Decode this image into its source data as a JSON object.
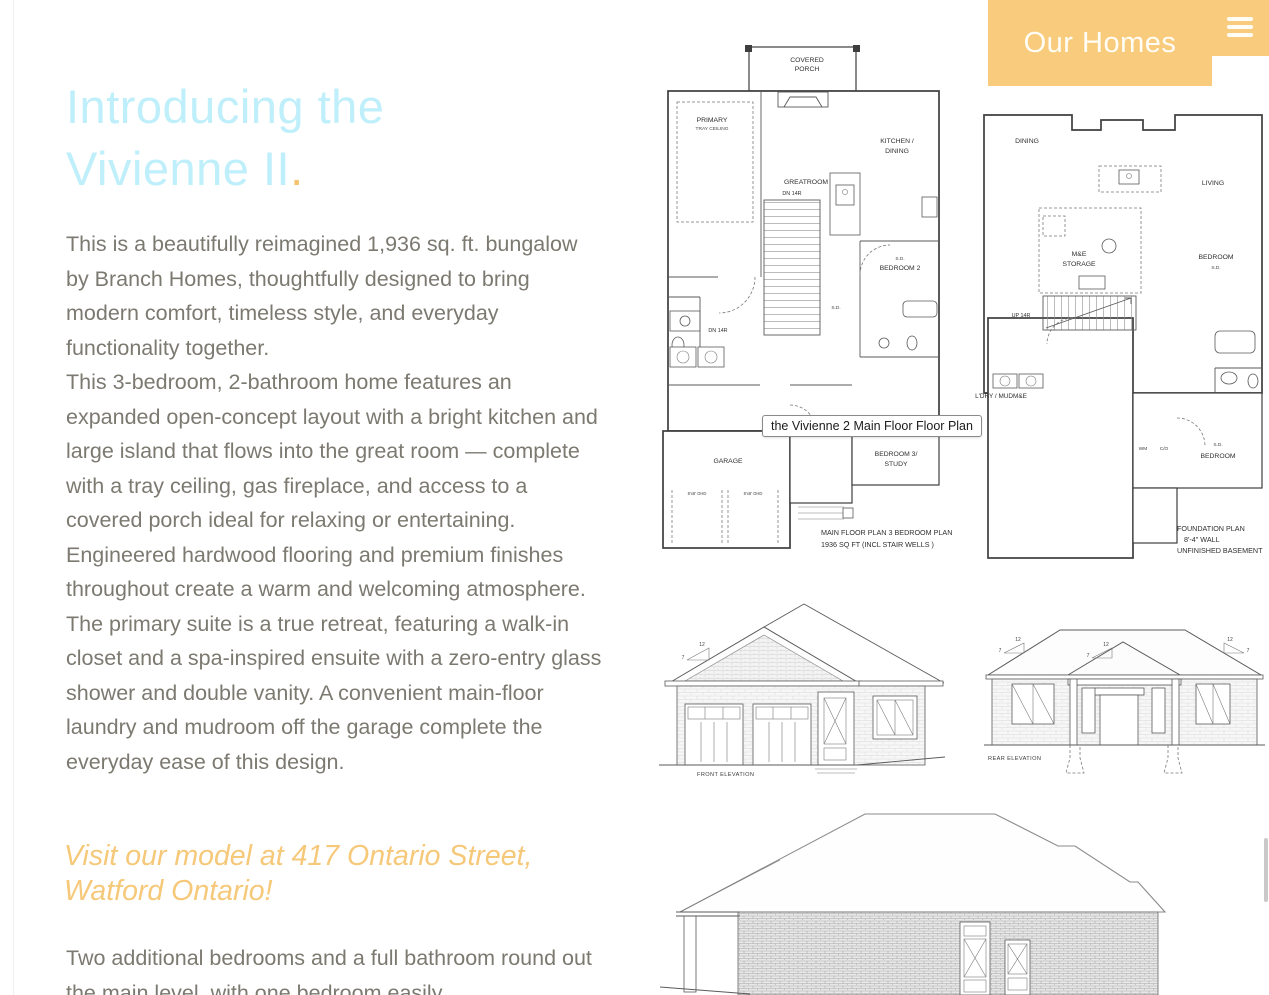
{
  "colors": {
    "accent_orange": "#f9cb7c",
    "title_cyan": "#bfeffa",
    "body_gray": "#7c7970",
    "callout_orange": "#f6c879"
  },
  "header": {
    "nav_label": "Our Homes"
  },
  "intro": {
    "title_line1": "Introducing the",
    "title_line2": "Vivienne II",
    "title_period": ".",
    "p1": "This is a beautifully reimagined 1,936 sq. ft. bungalow by Branch Homes, thoughtfully designed to bring modern comfort, timeless style, and everyday functionality together.",
    "p2": "This 3-bedroom, 2-bathroom home features an expanded open-concept layout with a bright kitchen and large island that flows into the great room — complete with a tray ceiling, gas fireplace, and access to a covered porch ideal for relaxing or entertaining. Engineered hardwood flooring and premium finishes throughout create a warm and welcoming atmosphere.",
    "p3": "The primary suite is a true retreat, featuring a walk-in closet and a spa-inspired ensuite with a zero-entry glass shower and double vanity. A convenient main-floor laundry and mudroom off the garage complete the everyday ease of this design.",
    "callout_line1": "Visit our model at 417 Ontario Street,",
    "callout_line2": "Watford Ontario!",
    "p4": "Two additional bedrooms and a full bathroom round out the main level, with one bedroom easily"
  },
  "tooltip": {
    "text": "the Vivienne 2 Main Floor Floor Plan"
  },
  "main_floor_plan": {
    "rooms": {
      "covered_porch_1": "COVERED",
      "covered_porch_2": "PORCH",
      "primary": "PRIMARY",
      "primary_sub": "TRAY CEILING",
      "greatroom": "GREATROOM",
      "kitchen_1": "KITCHEN /",
      "kitchen_2": "DINING",
      "bedroom2": "BEDROOM 2",
      "bedroom3_1": "BEDROOM 3/",
      "bedroom3_2": "STUDY",
      "garage": "GARAGE"
    },
    "notes": {
      "dn_stairs": "DN 14R",
      "sd": "S.D.",
      "garage_door": "8'x8' OHD"
    },
    "caption_line1": "MAIN FLOOR PLAN 3 BEDROOM PLAN",
    "caption_line2": "1936 SQ FT (INCL STAIR WELLS )"
  },
  "foundation_plan": {
    "rooms": {
      "dining": "DINING",
      "living": "LIVING",
      "storage_1": "M&E",
      "storage_2": "STORAGE",
      "bedroom_right": "BEDROOM",
      "laundry": "L'DRY / MUDM&E",
      "bedroom_bottom": "BEDROOM"
    },
    "notes": {
      "up_stairs": "UP 14R",
      "sd": "S.D.",
      "wm": "WM",
      "co": "C/O"
    },
    "caption_line1": "FOUNDATION PLAN",
    "caption_line2": "8'-4\" WALL",
    "caption_line3": "UNFINISHED BASEMENT"
  },
  "elevations": {
    "front_label": "FRONT ELEVATION",
    "rear_label": "REAR  ELEVATION",
    "pitch_rise": "12",
    "pitch_run": "7"
  }
}
